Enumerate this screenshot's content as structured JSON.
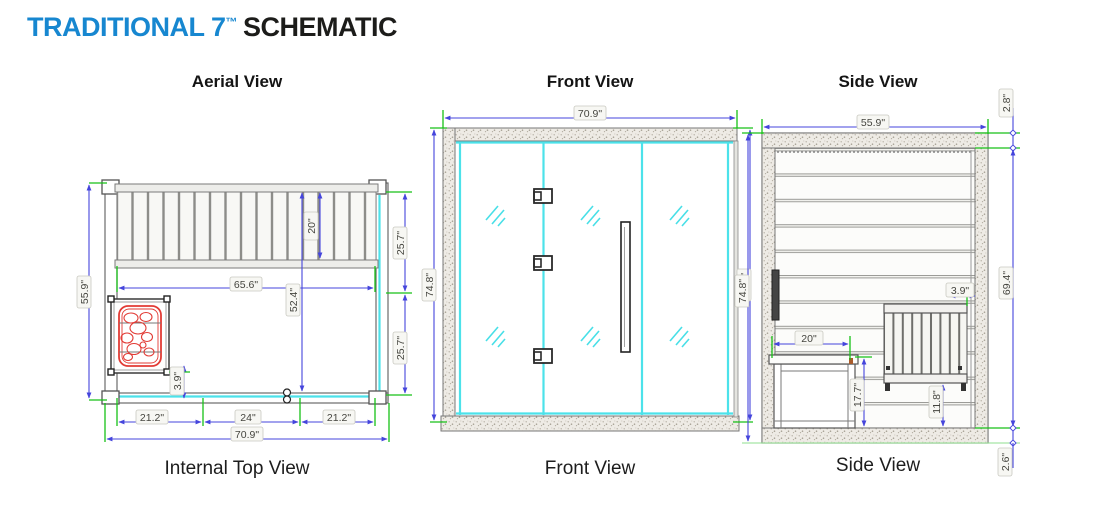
{
  "title": {
    "brand": "TRADITIONAL 7",
    "tm": "™",
    "word": "SCHEMATIC"
  },
  "colors": {
    "accent_blue": "#1787d0",
    "dimension_blue": "#4545dc",
    "extension_green": "#17c117",
    "glass_cyan": "#4ce2ea",
    "heater_red": "#e23b35"
  },
  "views": {
    "aerial": {
      "heading": "Aerial View",
      "footer": "Internal Top View",
      "dims": {
        "overall_depth": "55.9\"",
        "bench_depth": "20\"",
        "interior_depth": "52.4\"",
        "bench_length": "65.6\"",
        "right_segment_upper": "25.7\"",
        "right_segment_lower": "25.7\"",
        "heater_clearance": "3.9\"",
        "front_left_panel": "21.2\"",
        "door_width": "24\"",
        "front_right_panel": "21.2\"",
        "overall_width": "70.9\""
      }
    },
    "front": {
      "heading": "Front View",
      "footer": "Front View",
      "dims": {
        "overall_width": "70.9\"",
        "overall_height_left": "74.8\"",
        "overall_height_right": "74.8\""
      }
    },
    "side": {
      "heading": "Side View",
      "footer": "Side View",
      "dims": {
        "overall_depth": "55.9\"",
        "overall_height": "74.8\"",
        "roof_thickness": "2.8\"",
        "interior_height": "69.4\"",
        "floor_thickness": "2.6\"",
        "heater_wall_gap": "3.9\"",
        "bench_width": "20\"",
        "bench_height": "17.7\"",
        "heater_stand_height": "11.8\""
      }
    }
  }
}
